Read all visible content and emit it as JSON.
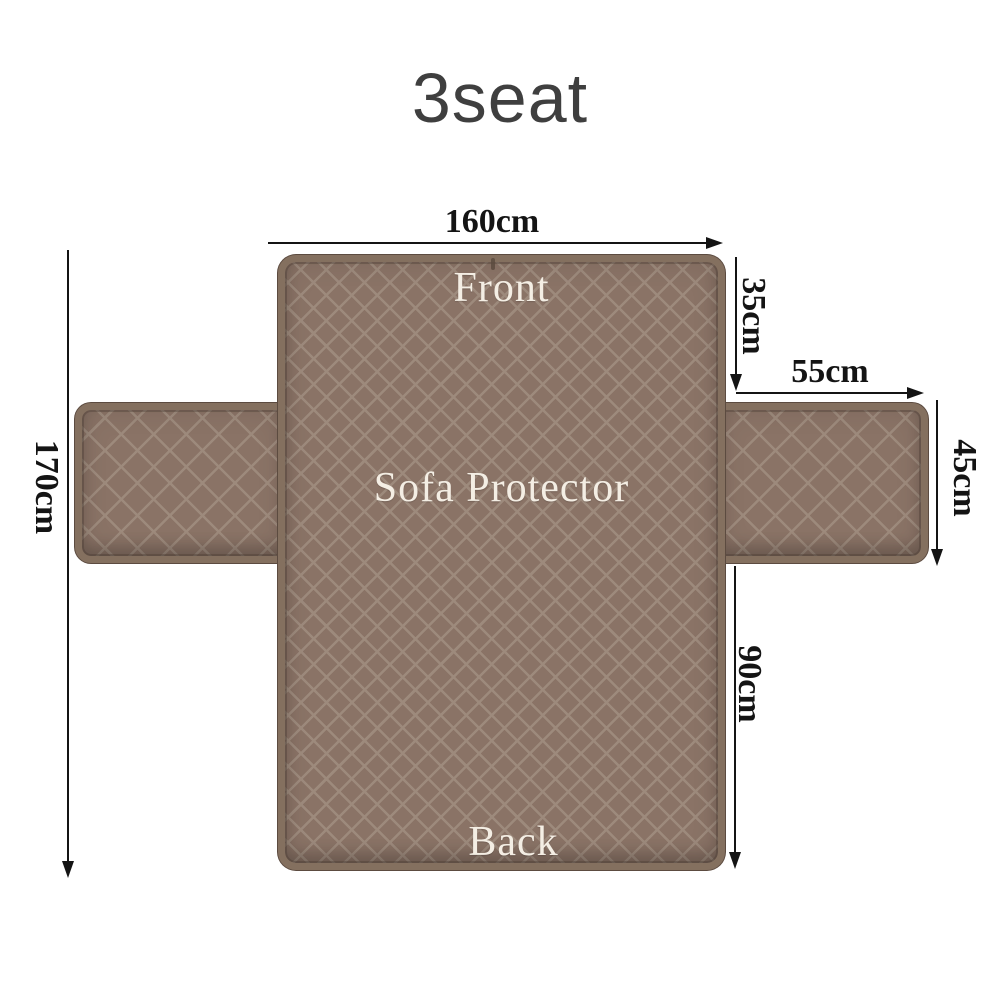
{
  "title": "3seat",
  "cover": {
    "front_label": "Front",
    "center_label": "Sofa Protector",
    "back_label": "Back"
  },
  "dimensions": {
    "total_width": "160cm",
    "total_length": "170cm",
    "front_section": "35cm",
    "armrest_width": "55cm",
    "armrest_length": "45cm",
    "back_section": "90cm"
  },
  "colors": {
    "fabric_base": "#8a7366",
    "fabric_lattice": "#9d8a7c",
    "fabric_binding": "#84705f",
    "fabric_edge_dark": "#5c4b40",
    "dimension_ink": "#141414",
    "label_text": "#f4eee4",
    "title_text": "#3f3f3f",
    "background": "#ffffff"
  }
}
